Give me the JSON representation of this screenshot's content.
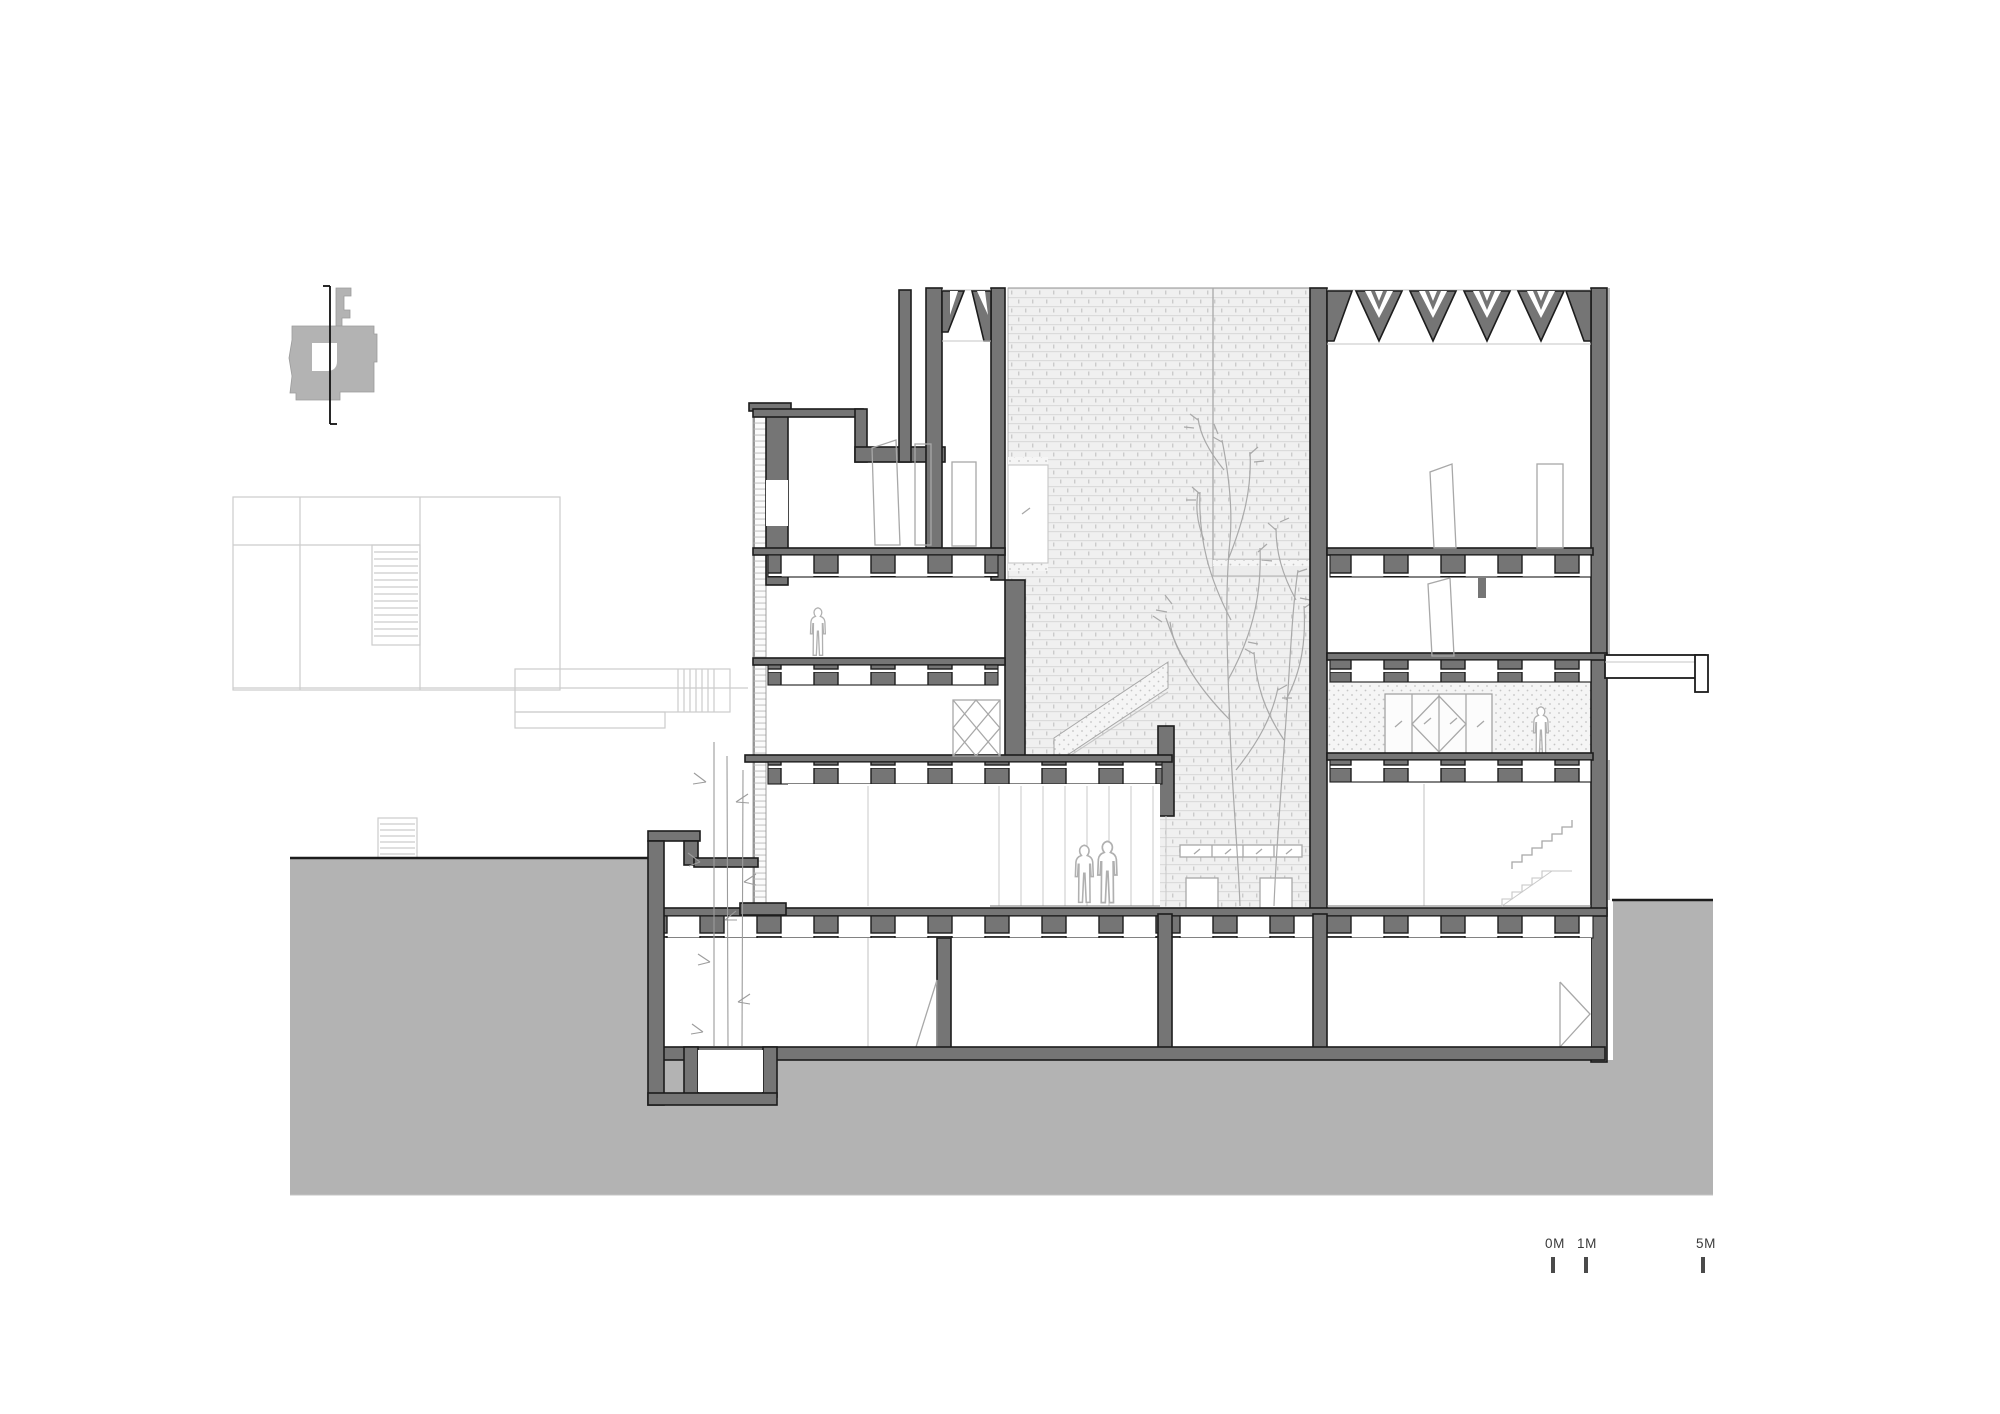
{
  "scale_bar": {
    "units": "meters",
    "marks": [
      {
        "label": "0M"
      },
      {
        "label": "1M"
      },
      {
        "label": "5M"
      }
    ]
  },
  "colors": {
    "background": "#ffffff",
    "ground": "#b3b3b3",
    "poche": "#757575",
    "outline": "#1c1c1c",
    "light": "#c6c6c6",
    "beyond": "#a8a8a8",
    "hatch_base": "#f0f0f0",
    "hatch_line": "#dbdbdb",
    "stipple_dot": "#c4c4c4",
    "figure": "#b0b0b0",
    "text": "#3a3a3a"
  }
}
